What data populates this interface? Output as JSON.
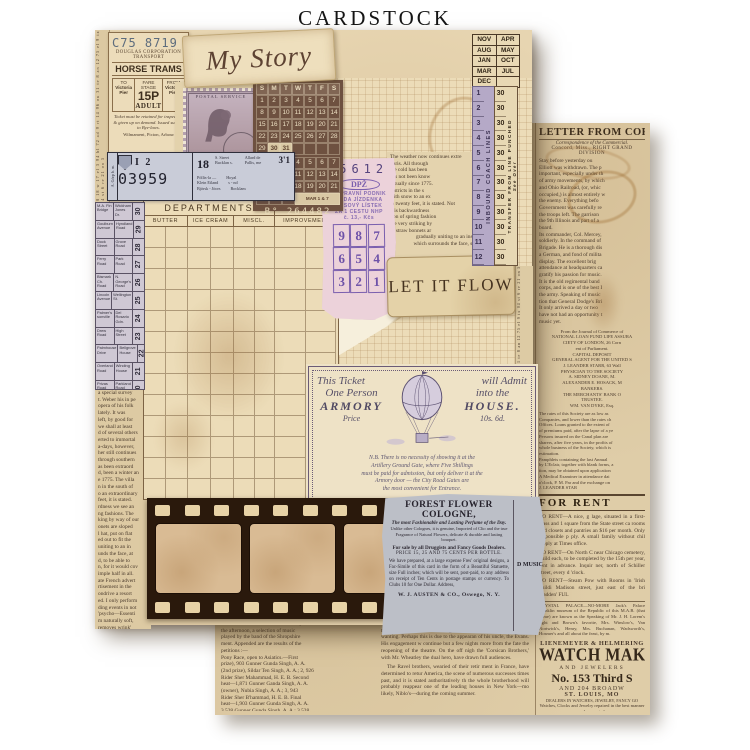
{
  "title": "CARDSTOCK",
  "front_sheet": {
    "left_sliver_text": "48 18 w 17 el 3 94 bl 72 ad 9 rt 14 96 ou 31 te 8 an 12 75 el 9 ix 04 st 6 re 21 on 5",
    "horse_ticket": {
      "serial": "C75 8719",
      "org1": "DOUGLAS CORPORATION",
      "org2": "TRANSPORT",
      "name": "HORSE TRAMS",
      "to_label": "TO",
      "to_place1": "Victoria",
      "to_place2": "Pier",
      "fare_label1": "FARE",
      "fare_label2": "STAGE",
      "fare": "15P",
      "fare_class": "ADULT",
      "from_label": "FROM",
      "from_place1": "Victoria",
      "from_place2": "Pier",
      "conditions": "Ticket must be retained for inspection & given up on demand.  Issued subject to Bye-laws.",
      "footer": "Wilmament, Picton, Arbour"
    },
    "my_story": "My Story",
    "stamp": {
      "top_text": "POSTAL SERVICE",
      "value": "12"
    },
    "calendar_card": {
      "days": [
        "S",
        "M",
        "T",
        "W",
        "T",
        "F",
        "S"
      ],
      "grid1": [
        [
          "1",
          "2",
          "3",
          "4",
          "5",
          "6",
          "7"
        ],
        [
          "8",
          "9",
          "10",
          "11",
          "12",
          "13",
          "14"
        ],
        [
          "15",
          "16",
          "17",
          "18",
          "19",
          "20",
          "21"
        ],
        [
          "22",
          "23",
          "24",
          "25",
          "26",
          "27",
          "28"
        ],
        [
          "29",
          "30",
          "31",
          "",
          "",
          "",
          ""
        ]
      ],
      "grid1_highlights": [
        "30",
        "31"
      ],
      "grid2": [
        [
          "1",
          "2",
          "3",
          "4",
          "5",
          "6",
          "7"
        ],
        [
          "8",
          "9",
          "10",
          "11",
          "12",
          "13",
          "14"
        ],
        [
          "15",
          "16",
          "17",
          "18",
          "19",
          "20",
          "21"
        ],
        [
          "22",
          "23",
          "24"
        ]
      ],
      "grid2_note": "MAR 1 & 7",
      "serial": "B° 264482"
    },
    "month_card": {
      "rows": [
        [
          "NOV",
          "APR"
        ],
        [
          "AUG",
          "MAY"
        ],
        [
          "JAN",
          "OCT"
        ],
        [
          "MAR",
          "JUL"
        ],
        [
          "DEC",
          ""
        ]
      ]
    },
    "inbound_strip": {
      "numbers": [
        "1",
        "2",
        "3",
        "4",
        "5",
        "6",
        "7",
        "8",
        "9",
        "10",
        "11",
        "12"
      ],
      "label": "INBOUND COACH LINES"
    },
    "transfer_strip": {
      "numbers": [
        "30",
        "30",
        "30",
        "30",
        "30",
        "30",
        "30",
        "30",
        "30",
        "30",
        "30",
        "30"
      ],
      "label": "TRANSFER FROM LINE PUNCHED",
      "note": "See Over"
    },
    "weather_clip": {
      "lines": [
        "The weather now continues extre",
        "Paris.   All through",
        "the cold has been",
        "has not been know",
        "actually since 1775.",
        "districts in the s",
        "with snow to an ex",
        "in twenty feet, it is stated.  Not",
        "this backwardness",
        "tion of spring fashion",
        "the very striking by",
        "of straw bonnets ar",
        "large round hat, pu",
        "edge scooped out"
      ],
      "wide_lines": [
        "gradually uniting to an insignifi-",
        "which surrounds the face, standing"
      ]
    },
    "pink_ticket": {
      "serial": "55612",
      "logo": "DPŽ",
      "stamp_lines": [
        "DOPRAVNÍ PODNIK",
        "ŘADA JÍZDENKA",
        "KUSOVÝ LÍSTEK",
        "ZA 1 CESTU NHP",
        "č. 13,- Kčs"
      ],
      "grid": [
        [
          "9",
          "8",
          "7"
        ],
        [
          "6",
          "5",
          "4"
        ],
        [
          "3",
          "2",
          "1"
        ]
      ]
    },
    "let_it_flow": "LET IT FLOW",
    "armory_ticket": {
      "r1a": "This Ticket",
      "r1b": "will Admit",
      "r2a": "One Person",
      "r2b": "into the",
      "r3a": "ARMORY",
      "r3b": "HOUSE.",
      "r4a": "Price",
      "r4b": "10s. 6d.",
      "para_lines": [
        "N.B.  There is no necessity of showing it at the",
        "Artillery Ground Gate, where Five Shillings",
        "must be paid for admission, but only deliver it at the",
        "Armory door — the City Road Gates are",
        "the most convenient for Entrance."
      ]
    },
    "ledger": {
      "title": "DEPARTMENTS",
      "equipment": "EQUIPMENT",
      "col1": "BUTTER",
      "col2": "ICE CREAM",
      "col3": "MISCL.",
      "col4": "IMPROVEMENT"
    },
    "blue_ticket": {
      "vert": "A. Görp b. m.",
      "block": "I 2",
      "serial": "03959",
      "num": "18",
      "mini1": "S. Street",
      "mini2": "Bucklan s.",
      "mini3": "Allard de",
      "mini4": "Pallis, me",
      "fare": "3'1",
      "rows": [
        [
          "Pöllis-la —",
          "Hoyal"
        ],
        [
          "Klein Eiland",
          "s - nd"
        ],
        [
          "Björsk - Jöors",
          "Bocklam"
        ]
      ]
    },
    "street_table": {
      "rows": [
        [
          "M.A. Fin Bridge",
          "Wickham Jones Dr.",
          "30"
        ],
        [
          "Goulburn Avenue",
          "Hyndland Road",
          "29"
        ],
        [
          "Dock Street",
          "Grove Road",
          "28"
        ],
        [
          "Ferry Road",
          "Park Road",
          "27"
        ],
        [
          "Bismark Ch. Road",
          "N. George's Road",
          "26"
        ],
        [
          "Lincoln Avenue",
          "Wellington St.",
          "25"
        ],
        [
          "Palmer's sonville",
          "Del Rosario Gdn.",
          "24"
        ],
        [
          "Drew Road",
          "High Street",
          "23"
        ],
        [
          "Palmhouse Drive",
          "Bellgrove House",
          "22"
        ],
        [
          "Overland Road",
          "Winding House",
          "21"
        ],
        [
          "Privas Road",
          "Parkland Road",
          "20"
        ]
      ]
    },
    "news_left": {
      "lines": [
        "a special survey",
        "t. Weber his in pe",
        "opera of his folk",
        "lately.   It was",
        "left, by good for",
        "we shall at least",
        "d of several others",
        "erted to immortal",
        "a-days, however,",
        "her still continues",
        "through southern",
        "as been extraord",
        "d, been a winter an",
        "e 1775.  The villa",
        "n in the south of",
        "o an extraordinary",
        "feet, it is stated.",
        "rdness we see an",
        "ng fashions.  The",
        "king by way of our",
        "onets are sloped",
        "l hat, put on flat",
        "ed out to fit the",
        "uniting to an in",
        "unds the face, at",
        "d, to be able to",
        "n, for it would cov",
        "imple half in all.",
        "",
        "ate French advert",
        "rtisement in the",
        "ondrive a resort",
        "ed.  I only perform",
        "ding events in not",
        "'psycho—Essenti",
        "m naturally soft,",
        "removes wrink'",
        "",
        "Amelie—Given",
        "t preserves the co",
        "Superstres—For"
      ]
    },
    "cologne_ad": {
      "headline": "FOREST FLOWER COLOGNE,",
      "subhead": "The most Fashionable and Lasting Perfume of the Day.",
      "tiny": "Unlike other Colognes, it is genuine, Imported of Clio and the true Fragrance of Natural Flowers, delicate & durable and lasting bouquet.",
      "sale": "For sale by all Druggists and Fancy Goods Dealers.",
      "price": "PRICE 15, 25 AND 75 CENTS PER BOTTLE.",
      "para": "We have prepared, at a large expense Fres' original designs, a Fac-Simile of this card in the form of a Beautiful Statuette, size Full inches; which will be sent, post-paid, to any address on receipt of Ten Cents in postage stamps or currency.   To Clubs 10 for One Dollar.    Address,",
      "signature": "W. J. AUSTEN & CO., Oswego, N. Y.",
      "side_header": "D MUSICAL."
    }
  },
  "back_sheet": {
    "filler_para": "nearly all of the towns along the line of the road, and he will be able to give the public a very correct idea of the condition of affairs in that quarter. The crops never looked better, and the planters are in good spirits, notwithstanding the scarcity of labor and the high price of provisions. It is understood that the committee will report at the next meeting, and that measures will then be taken to carry the plan into effect without delay.",
    "headline": "LETTER FROM COR",
    "dateline1": "Correspondence of the Commercial.",
    "dateline2": "Concord, Miss., RIGHT GRAND DIVISION",
    "para1_lines": [
      "Stay before yesterday ou",
      "Elliott was withdrawn.  The p",
      "important, especially under th",
      "of army movements, by which",
      "and Ohio Railroad, (or, whic",
      "occupied,) is almost entirely w",
      "the enemy.   Everything befo",
      "Government was carefully re",
      "the troops left.  The garrison",
      "the 9th Illinois and part of a",
      "board.",
      "Its commander, Col. Mercey,",
      "soldierly.  In the command of",
      "Brigade.  He is a thorough dis",
      "a German, and fond of milita",
      "display.   The excellent brig",
      "attendance at headquarters ca",
      "gratify his passion for music.",
      "It is the old regimental band",
      "corps, and is one of the best I",
      "the army.  Speaking of music",
      "tion that General Dodge's Bri",
      "It only arrived a day or two",
      "have not had an opportunity t",
      "music yet."
    ],
    "loan_lines": [
      "From the Journal of Commerce of",
      "NATIONAL LOAN FUND LIFE ASSURA",
      "CIETY OF LONDON, 26 Corn",
      "ent of Parliament.",
      "CAPITAL DEPOSIT",
      "GENERAL AGENT FOR THE UNITED S",
      "J. LEANDER STARR, 63 Wall",
      "PHYSICIAN TO THE SOCIETY",
      "A. SIDNEY DOANE, M.",
      "ALEXANDER E. HOSACK, M",
      "BANKERS.",
      "THE MERCHANTS' BANK O",
      "TRUSTEE.",
      "WM. VAN DYKE, Esq."
    ],
    "para3_lines": [
      "The rates of this Society are as low as",
      "Companies, and lower than the rates ch",
      "Offices.  Loans granted to the extent of",
      "of premiums paid, after the lapse of a ye",
      "Persons insured on the Canal plan are",
      "sharers, after five years, in the profits of",
      "whole business of the Society, which is",
      "estimation.",
      "Pamphlets containing the last Annual",
      "by L'Eclair, together with blank forms, a",
      "tion, may be obtained upon application",
      "A Medical Examiner in attendance dai",
      "o'clock, P. M.  Par and the exchange on",
      "J. LEANDER STAR"
    ],
    "for_rent": "FOR RENT",
    "ad1": "TO RENT—A nice, g lage, situated in a first-class and 1 square from the State street ca rooms and closets and pantries an $16 per month.  Only responsible p ply.  A small family without chil Apply at Times office.",
    "ad2": "TO RENT—On North C near Chicago cemetery, build each, to be completed by the 15th per year, rent in advance.  Inquir ner, north of Schiller street, every d 'clock.",
    "ad3": "TO RENT—Steam Pow with Rooms in 'Irish buildi Madison street, just east of the bri madden'   FUL",
    "crystal": "CRYSTAL PALACE—NO-MORE Jack's Palace Franklin museum of the Republic of this M.A.B. (that name) are known as the Speaking of Mr. J. H. Lorem's right and Brown's favorite, Mrs. Winslow's, Van Nortwick's, Henry, Mrs. Buchanan, Wadsworth's, Hosmer's and all about the feast, by m.",
    "firm": "LIENEMEYER & HELMERING",
    "watch_big": "WATCH MAKER",
    "watch_jew": "AND JEWELERS",
    "addr1": "No. 153 Third S",
    "addr2": "AND 204 BROADW",
    "city": "ST. LOUIS, MO",
    "dealers": "DEALERS IN WATCHES, JEWELRY, FANCY GO",
    "repair": "Watches, Clocks and Jewelry repaired in the best manner and warranted.",
    "bar": "A VERY LARGE PAINT, FOR",
    "bottom_col1": [
      "will have to meet the Asiatic Artillery.",
      "the afternoon, a selection of music",
      "played by the band of the Shropshire",
      "ment.  Appended are the results of the",
      "petitions :—",
      "Pony Race, open to Asiatics.—First",
      "prize), 903 Gunner Gunda Singh, A. A.",
      "(2nd prize), Sildar Ten Singh, A. A.; 2, 926",
      "Rider Sher Mahammad, H. E. B.  Second",
      "heat—1,871 Gunner Ganda Singh, A. A.",
      "(owner), Nubia Singh, A. A.; 3, 943",
      "Rider Sher B'hammad, H. E. B.  Final",
      "heat—1,903 Gunner Gunda Singh, A. A.",
      "3,528 Gunner Gunda Singh, A. A.; 3,528",
      "Riding Sher Mahammad, H. E. B."
    ],
    "bottom_col2_p1": "Niblo's, New York, to full audiences, alterna King Lear and Othello, the wonted audience rehearsing the eminent tragedian is manifest wanting.  Perhaps this is due to the appearan of his uncle, the Evans.  His engagement w continue but a few nights more from the fate the reopening of the theatre.  On the off nigh the 'Corsican Brothers,' with Mr. Wheatley the dual hero, have drawn full audiences.",
    "bottom_col2_p2": "The Ravel brothers, wearied of their retir ment in France, have determined to retur America, the scene of numerous successes times past, and it is stated authoritatively th the whole brotherhood will probably reappear one of the leading houses in New York—mo likely, Niblo's—during the coming summer."
  }
}
